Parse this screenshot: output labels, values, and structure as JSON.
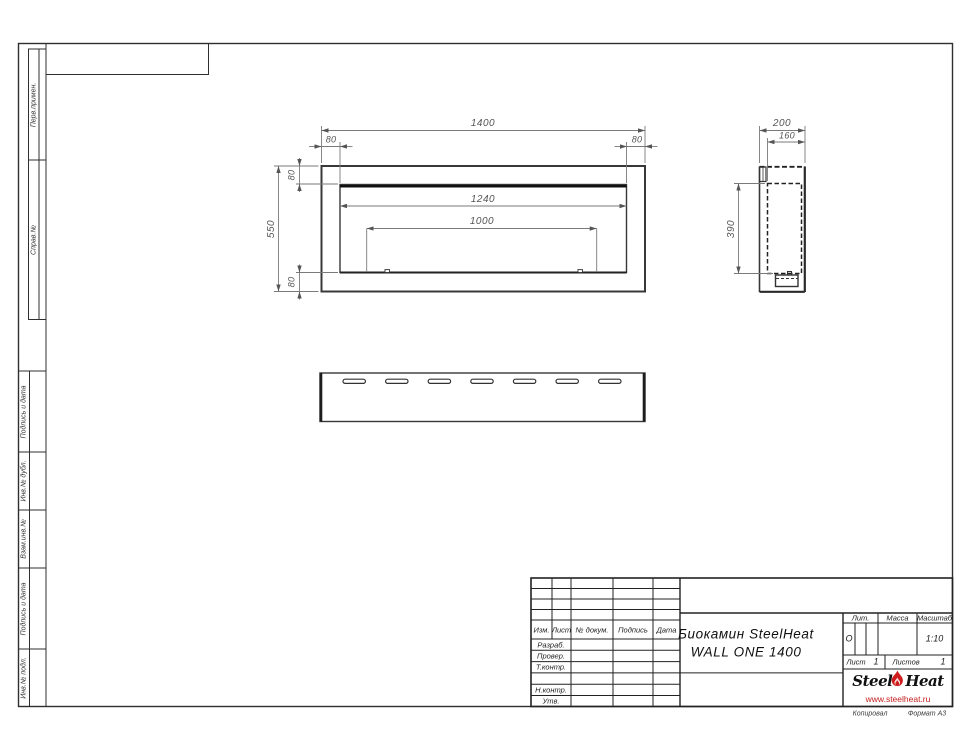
{
  "frame": {
    "left_strip_labels": [
      "Перв.примен.",
      "Справ.№",
      "Подпись и дата",
      "Инв.№ дубл.",
      "Взам.инв.№",
      "Подпись и дата",
      "Инв.№ подл."
    ]
  },
  "dims": {
    "front_width": "1400",
    "front_height": "550",
    "offset": "80",
    "opening_width": "1240",
    "burner_width": "1000",
    "depth": "200",
    "inner_depth": "160",
    "inner_height": "390"
  },
  "title_block": {
    "cols": {
      "izm": "Изм.",
      "list": "Лист",
      "doc": "№ докум.",
      "sign": "Подпись",
      "date": "Дата"
    },
    "rows": {
      "razrab": "Разраб.",
      "prover": "Провер.",
      "tkontr": "Т.контр.",
      "nkontr": "Н.контр.",
      "utv": "Утв."
    },
    "title1": "Биокамин SteelHeat",
    "title2": "WALL ONE 1400",
    "lit_label": "Лит.",
    "lit_value": "О",
    "mass_label": "Масса",
    "scale_label": "Масштаб",
    "scale_value": "1:10",
    "sheet_label": "Лист",
    "sheet_value": "1",
    "sheets_label": "Листов",
    "sheets_value": "1"
  },
  "logo": {
    "steel": "Steel",
    "heat": "Heat",
    "site": "www.steelheat.ru"
  },
  "footer": {
    "copied": "Копировал",
    "format": "Формат А3"
  },
  "colors": {
    "logo_red": "#cf1d1d",
    "object_line": "#343434",
    "dim_line": "#7a7a7a"
  }
}
